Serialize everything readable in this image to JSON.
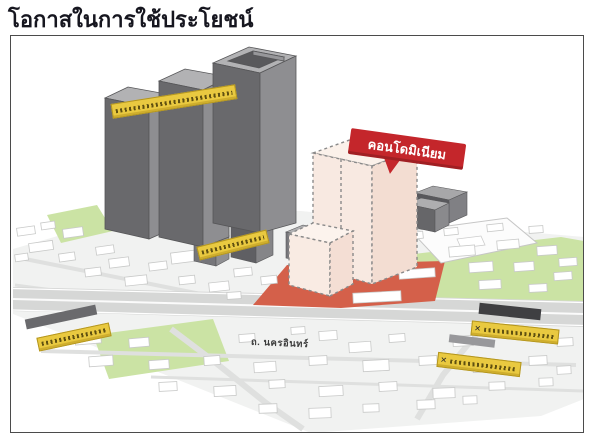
{
  "title": "โอกาสในการใช้ประโยชน์",
  "map": {
    "condo_banner_label": "คอนโดมิเนียม",
    "road_label": "ถ. นครอินทร์",
    "sign_cross_mark": "✕"
  },
  "colors": {
    "banner_red": "#c4262b",
    "plot_red": "#d4604a",
    "sign_yellow": "#e9c940",
    "tower_gray": "#69696c",
    "condo_fill": "#f8e9e1",
    "green_area": "#cbe3a4"
  }
}
